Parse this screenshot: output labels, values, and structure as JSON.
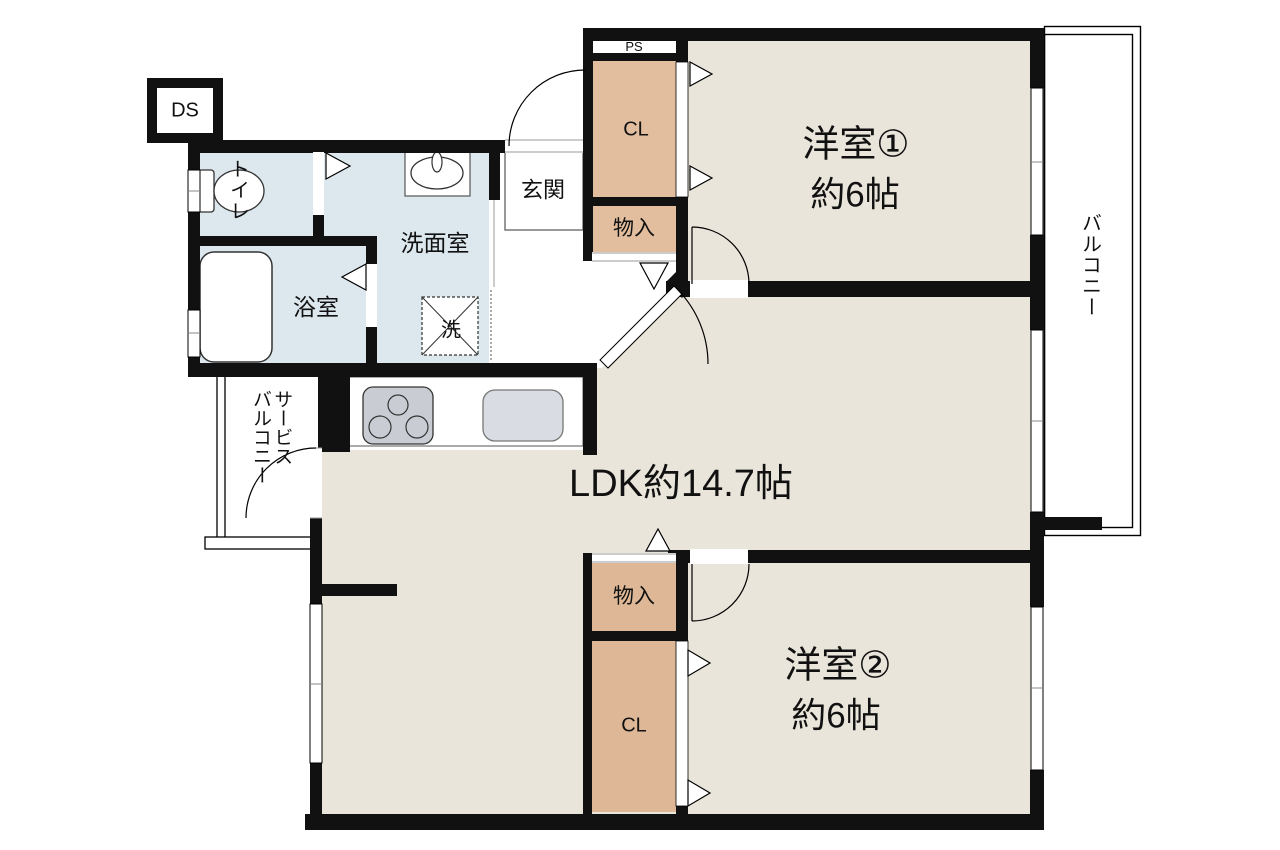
{
  "title": "2LDK apartment floor plan",
  "rooms": {
    "yoshitsu1": {
      "name": "洋室①",
      "size": "約6帖"
    },
    "yoshitsu2": {
      "name": "洋室②",
      "size": "約6帖"
    },
    "ldk": {
      "name_size": "LDK約14.7帖"
    },
    "genkan": {
      "name": "玄関"
    },
    "toilet": {
      "name": "トイレ"
    },
    "senmen": {
      "name": "洗面室"
    },
    "yokushitsu": {
      "name": "浴室"
    },
    "balcony": {
      "name": "バルコニー"
    },
    "service_balcony": {
      "name": "サービス\nバルコニー"
    }
  },
  "storage": {
    "cl_top": "CL",
    "cl_bottom": "CL",
    "monoiri_top": "物入",
    "monoiri_bottom": "物入",
    "ps": "PS",
    "ds": "DS"
  },
  "fixtures": {
    "washer_mark": "洗"
  },
  "colors": {
    "room_floor": "#EAE5DA",
    "closet_fill": "#E2BE9E",
    "wet_area_fill": "#DCE8EE",
    "wall": "#111111",
    "stove_fill": "#C9CDD3",
    "sink_fill": "#D9DDE3",
    "background": "#FFFFFF"
  }
}
